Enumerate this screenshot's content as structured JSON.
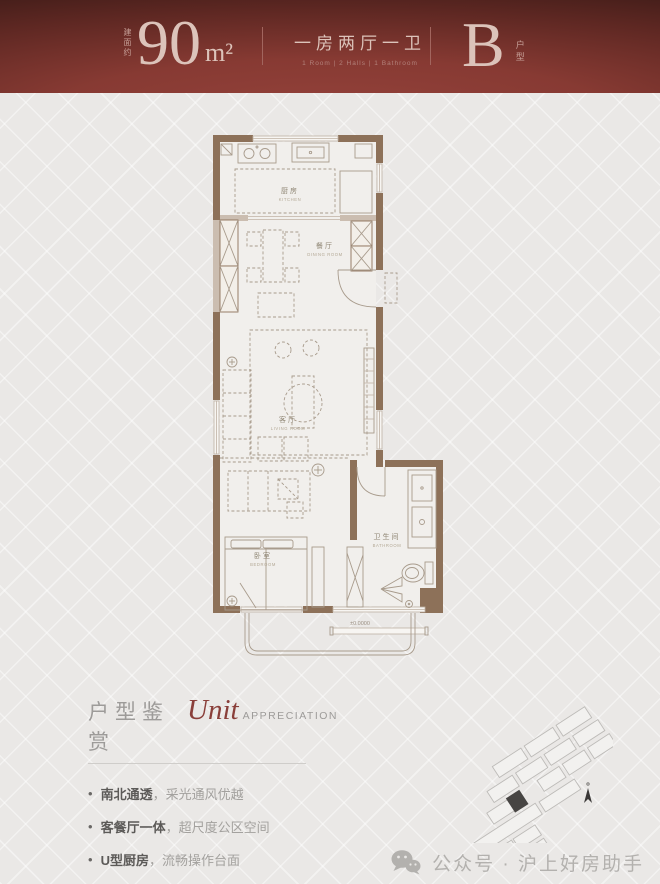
{
  "header": {
    "area_prefix": "建面约",
    "area_value": "90",
    "area_unit": "m²",
    "layout_cn": "一房两厅一卫",
    "layout_en": "1 Room | 2 Halls | 1 Bathroom",
    "unit_letter": "B",
    "unit_label": "户型"
  },
  "floorplan": {
    "rooms": [
      {
        "cn": "厨房",
        "en": "KITCHEN"
      },
      {
        "cn": "餐厅",
        "en": "DINING ROOM"
      },
      {
        "cn": "客厅",
        "en": "LIVING ROOM"
      },
      {
        "cn": "卧室",
        "en": "BEDROOM"
      },
      {
        "cn": "卫生间",
        "en": "BATHROOM"
      }
    ],
    "elevation_mark": "±0.0000"
  },
  "appreciation": {
    "title_cn": "户型鉴赏",
    "title_script": "Unit",
    "title_en": "APPRECIATION",
    "bullets": [
      {
        "head": "南北通透",
        "tail": "，采光通风优越"
      },
      {
        "head": "客餐厅一体",
        "tail": "，超尺度公区空间"
      },
      {
        "head": "U型厨房",
        "tail": "，流畅操作台面"
      },
      {
        "head": "南向套房",
        "tail": "，栖心静谧私屿"
      }
    ]
  },
  "footer": {
    "wechat_label": "公众号 · 沪上好房助手"
  },
  "colors": {
    "header_red": "#7e332e",
    "header_text_pink": "#dcc3ba",
    "wall_brown": "#8d7159",
    "script_red": "#8a3f3a",
    "page_bg": "#eae8e6"
  }
}
